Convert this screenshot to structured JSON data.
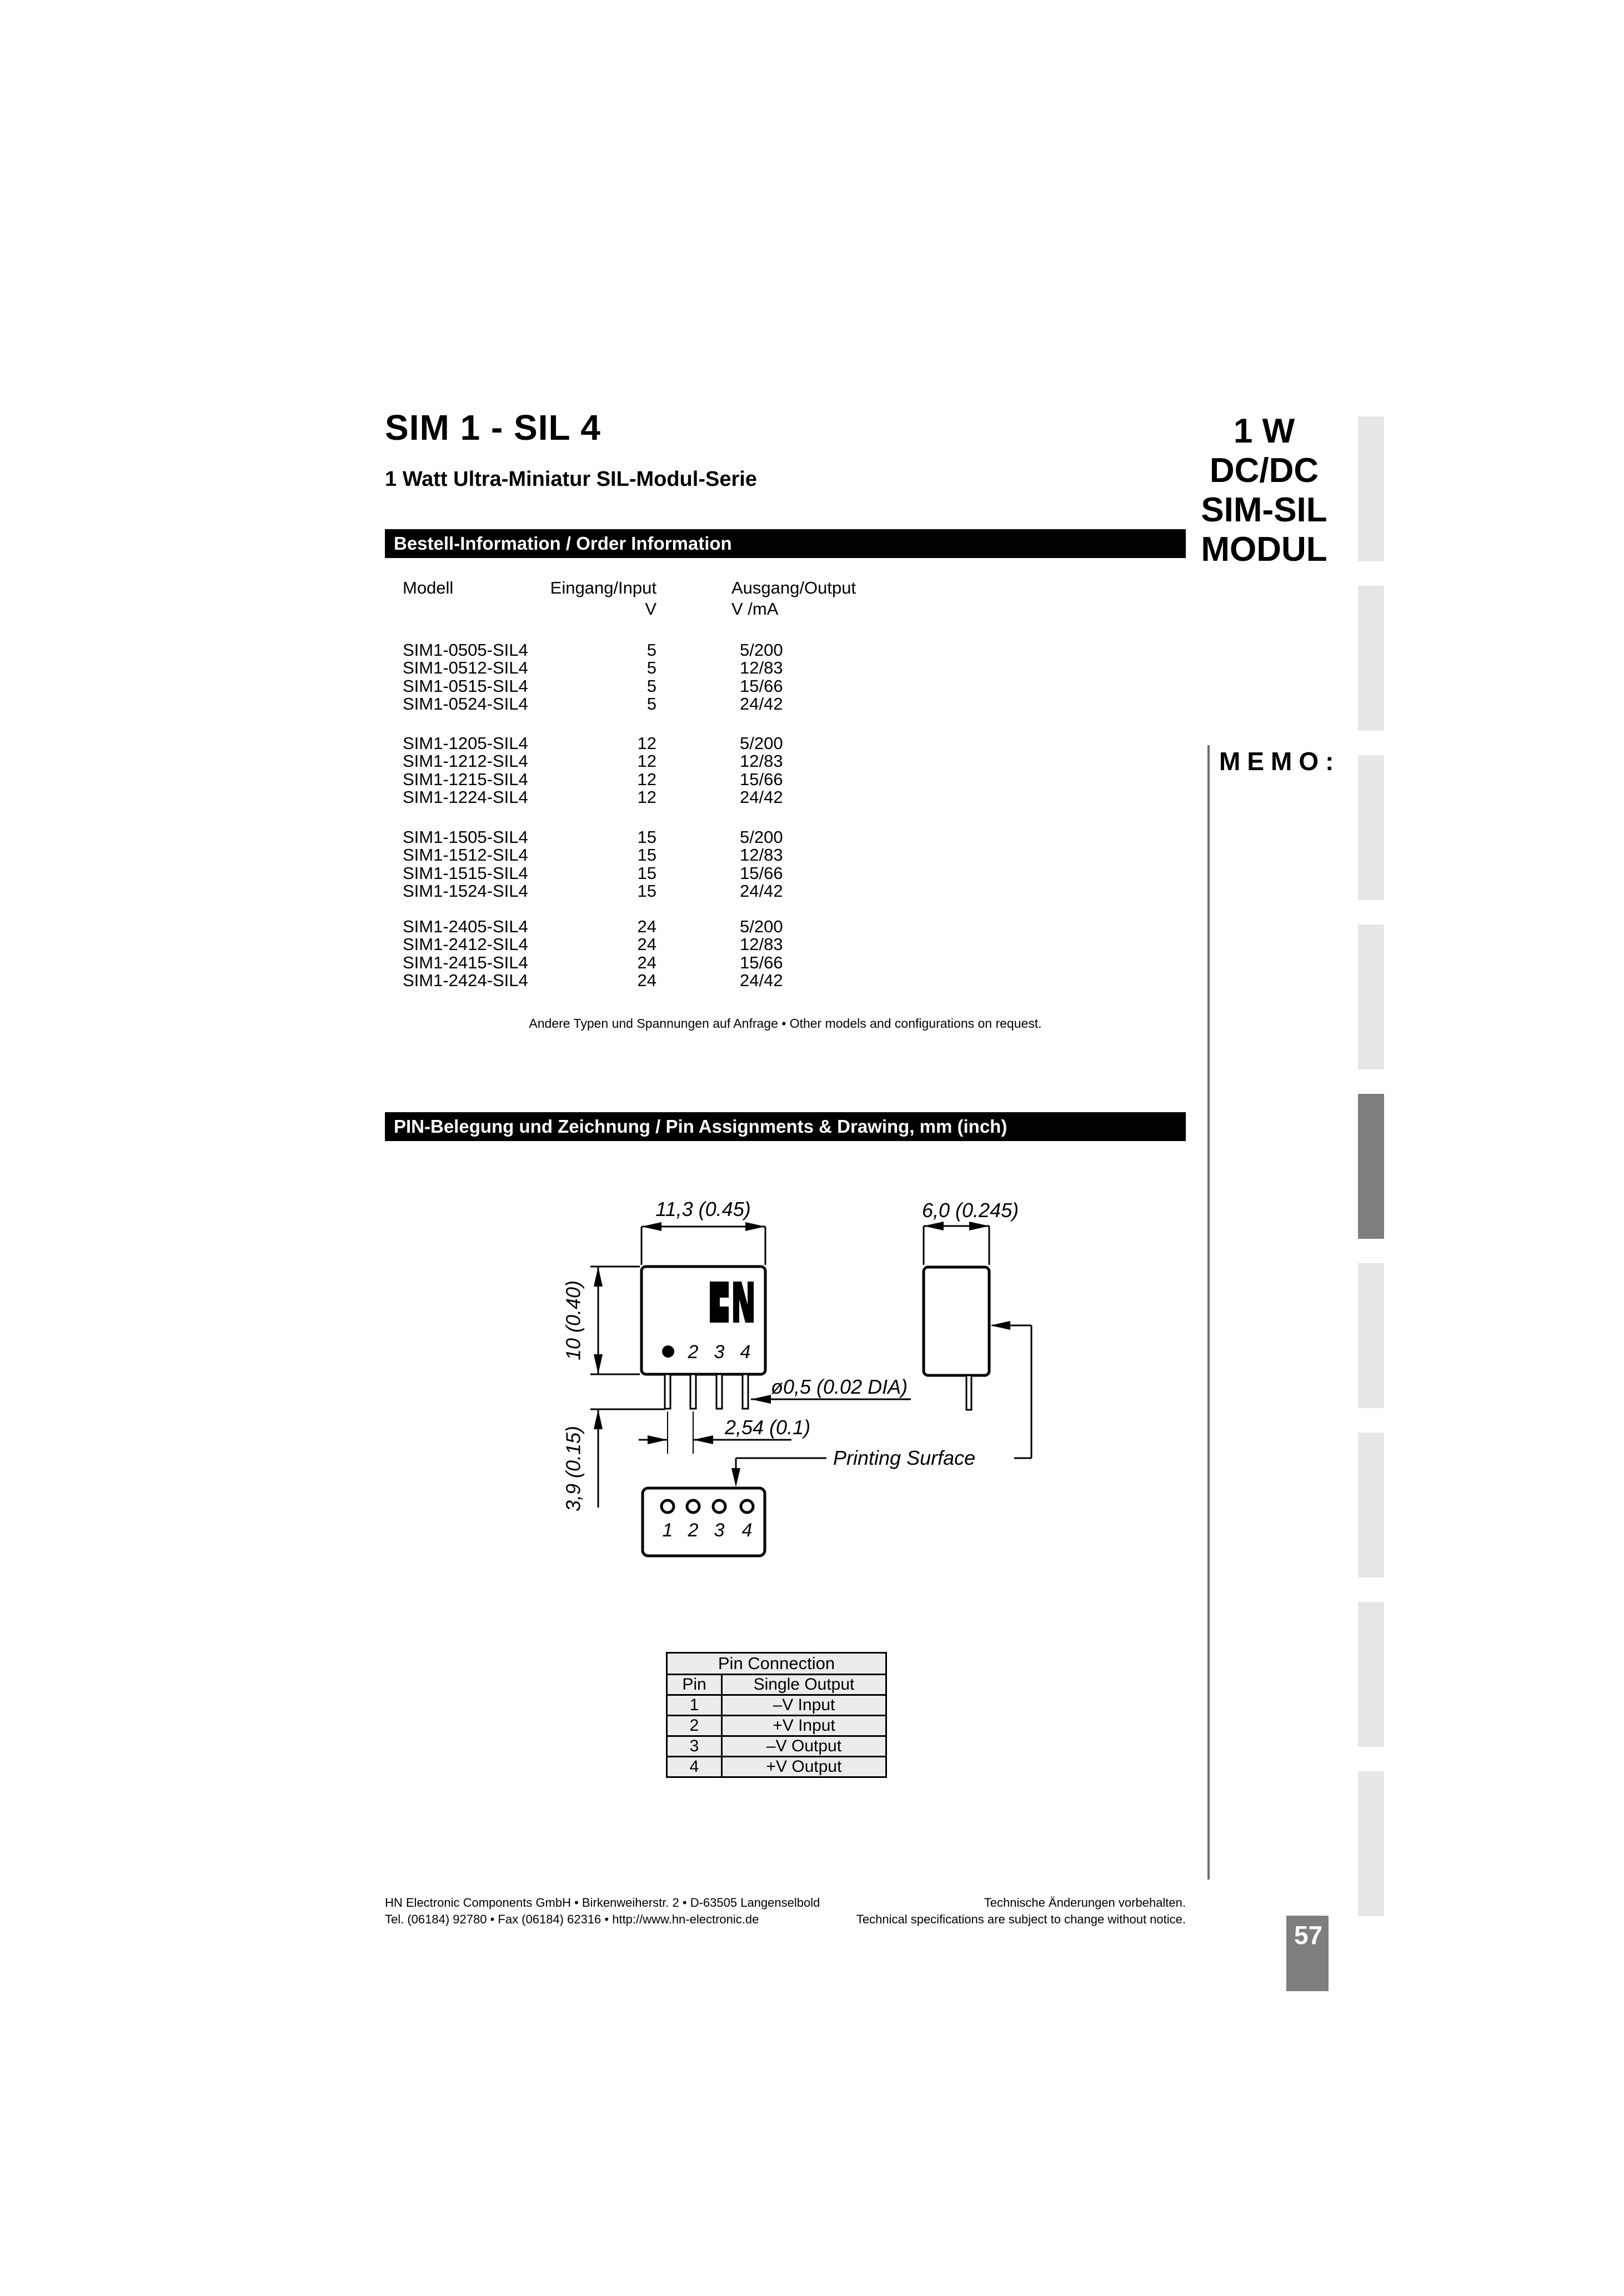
{
  "header": {
    "title": "SIM 1 - SIL 4",
    "subtitle": "1 Watt Ultra-Miniatur SIL-Modul-Serie",
    "product_lines": [
      "1 W",
      "DC/DC",
      "SIM-SIL",
      "MODUL"
    ]
  },
  "memo_label": "MEMO:",
  "sections": {
    "order_bar": "Bestell-Information / Order Information",
    "pin_bar": "PIN-Belegung  und Zeichnung / Pin Assignments & Drawing,  mm (inch)"
  },
  "order_table": {
    "col_model": "Modell",
    "col_input": "Eingang/Input",
    "col_input_unit": "V",
    "col_output": "Ausgang/Output",
    "col_output_unit": "V /mA",
    "groups": [
      {
        "rows": [
          {
            "model": "SIM1-0505-SIL4",
            "input": "5",
            "output": "5/200"
          },
          {
            "model": "SIM1-0512-SIL4",
            "input": "5",
            "output": "12/83"
          },
          {
            "model": "SIM1-0515-SIL4",
            "input": "5",
            "output": "15/66"
          },
          {
            "model": "SIM1-0524-SIL4",
            "input": "5",
            "output": "24/42"
          }
        ]
      },
      {
        "rows": [
          {
            "model": "SIM1-1205-SIL4",
            "input": "12",
            "output": "5/200"
          },
          {
            "model": "SIM1-1212-SIL4",
            "input": "12",
            "output": "12/83"
          },
          {
            "model": "SIM1-1215-SIL4",
            "input": "12",
            "output": "15/66"
          },
          {
            "model": "SIM1-1224-SIL4",
            "input": "12",
            "output": "24/42"
          }
        ]
      },
      {
        "rows": [
          {
            "model": "SIM1-1505-SIL4",
            "input": "15",
            "output": "5/200"
          },
          {
            "model": "SIM1-1512-SIL4",
            "input": "15",
            "output": "12/83"
          },
          {
            "model": "SIM1-1515-SIL4",
            "input": "15",
            "output": "15/66"
          },
          {
            "model": "SIM1-1524-SIL4",
            "input": "15",
            "output": "24/42"
          }
        ]
      },
      {
        "rows": [
          {
            "model": "SIM1-2405-SIL4",
            "input": "24",
            "output": "5/200"
          },
          {
            "model": "SIM1-2412-SIL4",
            "input": "24",
            "output": "12/83"
          },
          {
            "model": "SIM1-2415-SIL4",
            "input": "24",
            "output": "15/66"
          },
          {
            "model": "SIM1-2424-SIL4",
            "input": "24",
            "output": "24/42"
          }
        ]
      }
    ],
    "note": "Andere Typen und Spannungen auf Anfrage • Other models and configurations on request."
  },
  "drawing": {
    "dim_width": "11,3 (0.45)",
    "dim_height": "10 (0.40)",
    "dim_pin_length": "3,9 (0.15)",
    "dim_side_width": "6,0 (0.245)",
    "dim_pin_diameter": "ø0,5 (0.02 DIA)",
    "dim_pin_pitch": "2,54 (0.1)",
    "printing_surface": "Printing Surface",
    "front_pin_labels": [
      "2",
      "3",
      "4"
    ],
    "bottom_pin_labels": [
      "1",
      "2",
      "3",
      "4"
    ]
  },
  "pin_table": {
    "title": "Pin Connection",
    "col_pin": "Pin",
    "col_output": "Single Output",
    "rows": [
      {
        "pin": "1",
        "function": "–V Input"
      },
      {
        "pin": "2",
        "function": "+V Input"
      },
      {
        "pin": "3",
        "function": "–V Output"
      },
      {
        "pin": "4",
        "function": "+V Output"
      }
    ]
  },
  "footer": {
    "left_line1": "HN Electronic Components GmbH • Birkenweiherstr. 2 • D-63505 Langenselbold",
    "left_line2": "Tel. (06184) 92780 • Fax (06184) 62316 • http://www.hn-electronic.de",
    "right_line1": "Technische Änderungen vorbehalten.",
    "right_line2": "Technical specifications are subject to change without notice.",
    "page_number": "57"
  },
  "colors": {
    "tab_light": "#e6e6e6",
    "tab_dark": "#7e7e7e",
    "badge": "#7e7e7e",
    "bar": "#000000"
  }
}
